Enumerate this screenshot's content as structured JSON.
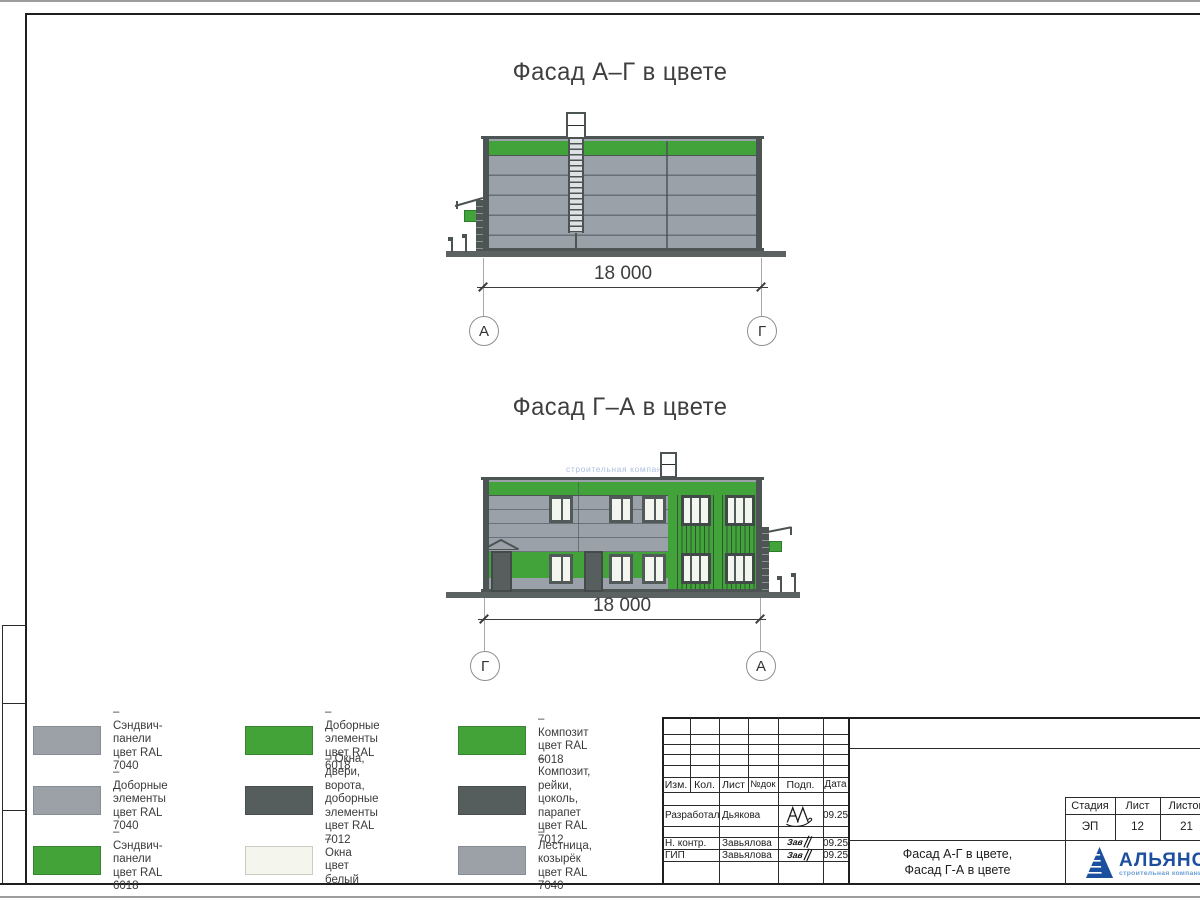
{
  "palette": {
    "ral7040_gray": "#9ba1a7",
    "ral6018_green": "#41a33a",
    "ral7012_dark": "#565e5d",
    "window_white": "#f4f6ee",
    "logo_blue": "#1d4f9f",
    "logo_light_blue": "#6aa0d6"
  },
  "facade1": {
    "title": "Фасад А–Г в цвете",
    "dimension": "18 000",
    "axis_left": "А",
    "axis_right": "Г"
  },
  "facade2": {
    "title": "Фасад Г–А в цвете",
    "dimension": "18 000",
    "axis_left": "Г",
    "axis_right": "А",
    "watermark": "строительная компания"
  },
  "legend": {
    "items": [
      {
        "label": "– Сэндвич-панели\nцвет RAL 7040",
        "color": "#9ba1a7"
      },
      {
        "label": "– Доборные элементы\nцвет RAL 7040",
        "color": "#9ba1a7"
      },
      {
        "label": "– Сэндвич-панели\nцвет RAL 6018",
        "color": "#43a339"
      },
      {
        "label": "– Доборные элементы\nцвет RAL 6018",
        "color": "#43a339"
      },
      {
        "label": "– Окна, двери, ворота,\nдоборные элементы\nцвет RAL 7012",
        "color": "#565e5d"
      },
      {
        "label": "– Окна\nцвет белый",
        "color": "#f4f6ee"
      },
      {
        "label": "– Композит\nцвет RAL 6018",
        "color": "#43a339"
      },
      {
        "label": "– Композит, рейки,\nцоколь, парапет\nцвет RAL 7012",
        "color": "#565e5d"
      },
      {
        "label": "– Лестница, козырёк\nцвет RAL 7040",
        "color": "#9ba1a7"
      }
    ]
  },
  "titleblock": {
    "header_cells": [
      "Изм.",
      "Кол.",
      "Лист",
      "№док",
      "Подп.",
      "Дата"
    ],
    "rows": [
      {
        "role": "Разработал",
        "name": "Дьякова",
        "date": "09.25"
      },
      {
        "role": "Н. контр.",
        "name": "Завьялова",
        "date": "09.25"
      },
      {
        "role": "ГИП",
        "name": "Завьялова",
        "date": "09.25"
      }
    ],
    "stage_label": "Стадия",
    "sheet_label": "Лист",
    "sheets_label": "Листов",
    "stage": "ЭП",
    "sheet": "12",
    "sheets": "21",
    "sheet_title": "Фасад А-Г в цвете,\nФасад Г-А в цвете",
    "logo_name": "АЛЬЯНС",
    "logo_subtitle": "строительная компания"
  }
}
